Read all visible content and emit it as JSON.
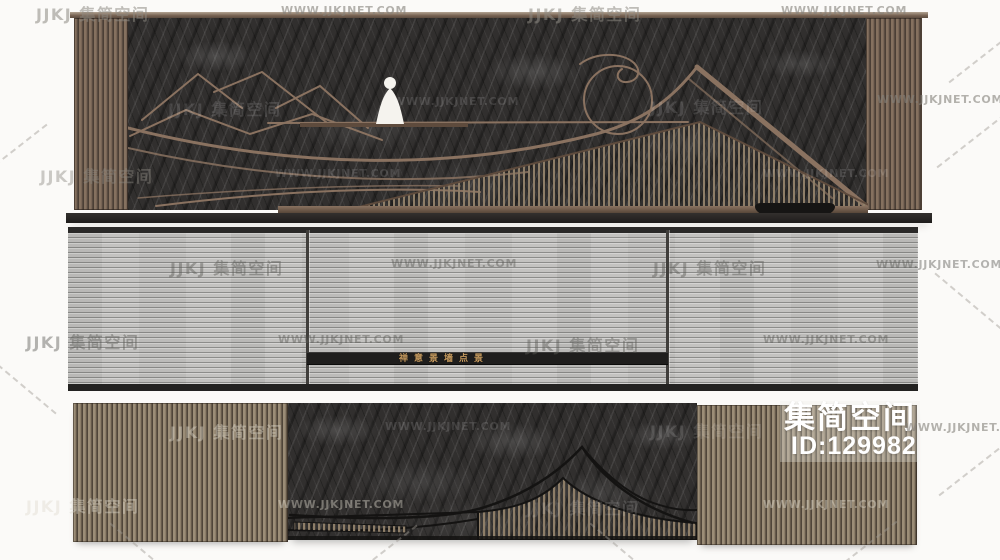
{
  "watermarks": {
    "brand": "JJKJ 集简空间",
    "site": "WWW.JJKJNET.COM"
  },
  "product_badge": {
    "name": "集简空间",
    "id": "ID:129982"
  },
  "middle_panel": {
    "plaque_text": "禅意景墙点景"
  },
  "colors": {
    "page_bg": "#fbfaf8",
    "bronze": "#8a7260",
    "bronze_dark": "#5e4b3d",
    "dark_line": "#141312",
    "rock": "#312f2e",
    "gray_wall": "#c3c2c0",
    "plaque_bg": "#1f1e1d",
    "plaque_gold": "#c59a5f",
    "slat_light": "#9b8d77",
    "slat_dark": "#4f4539",
    "slat_fill": "#8e7e68",
    "figure_white": "#f5f3ee",
    "badge_text": "#ffffff"
  }
}
